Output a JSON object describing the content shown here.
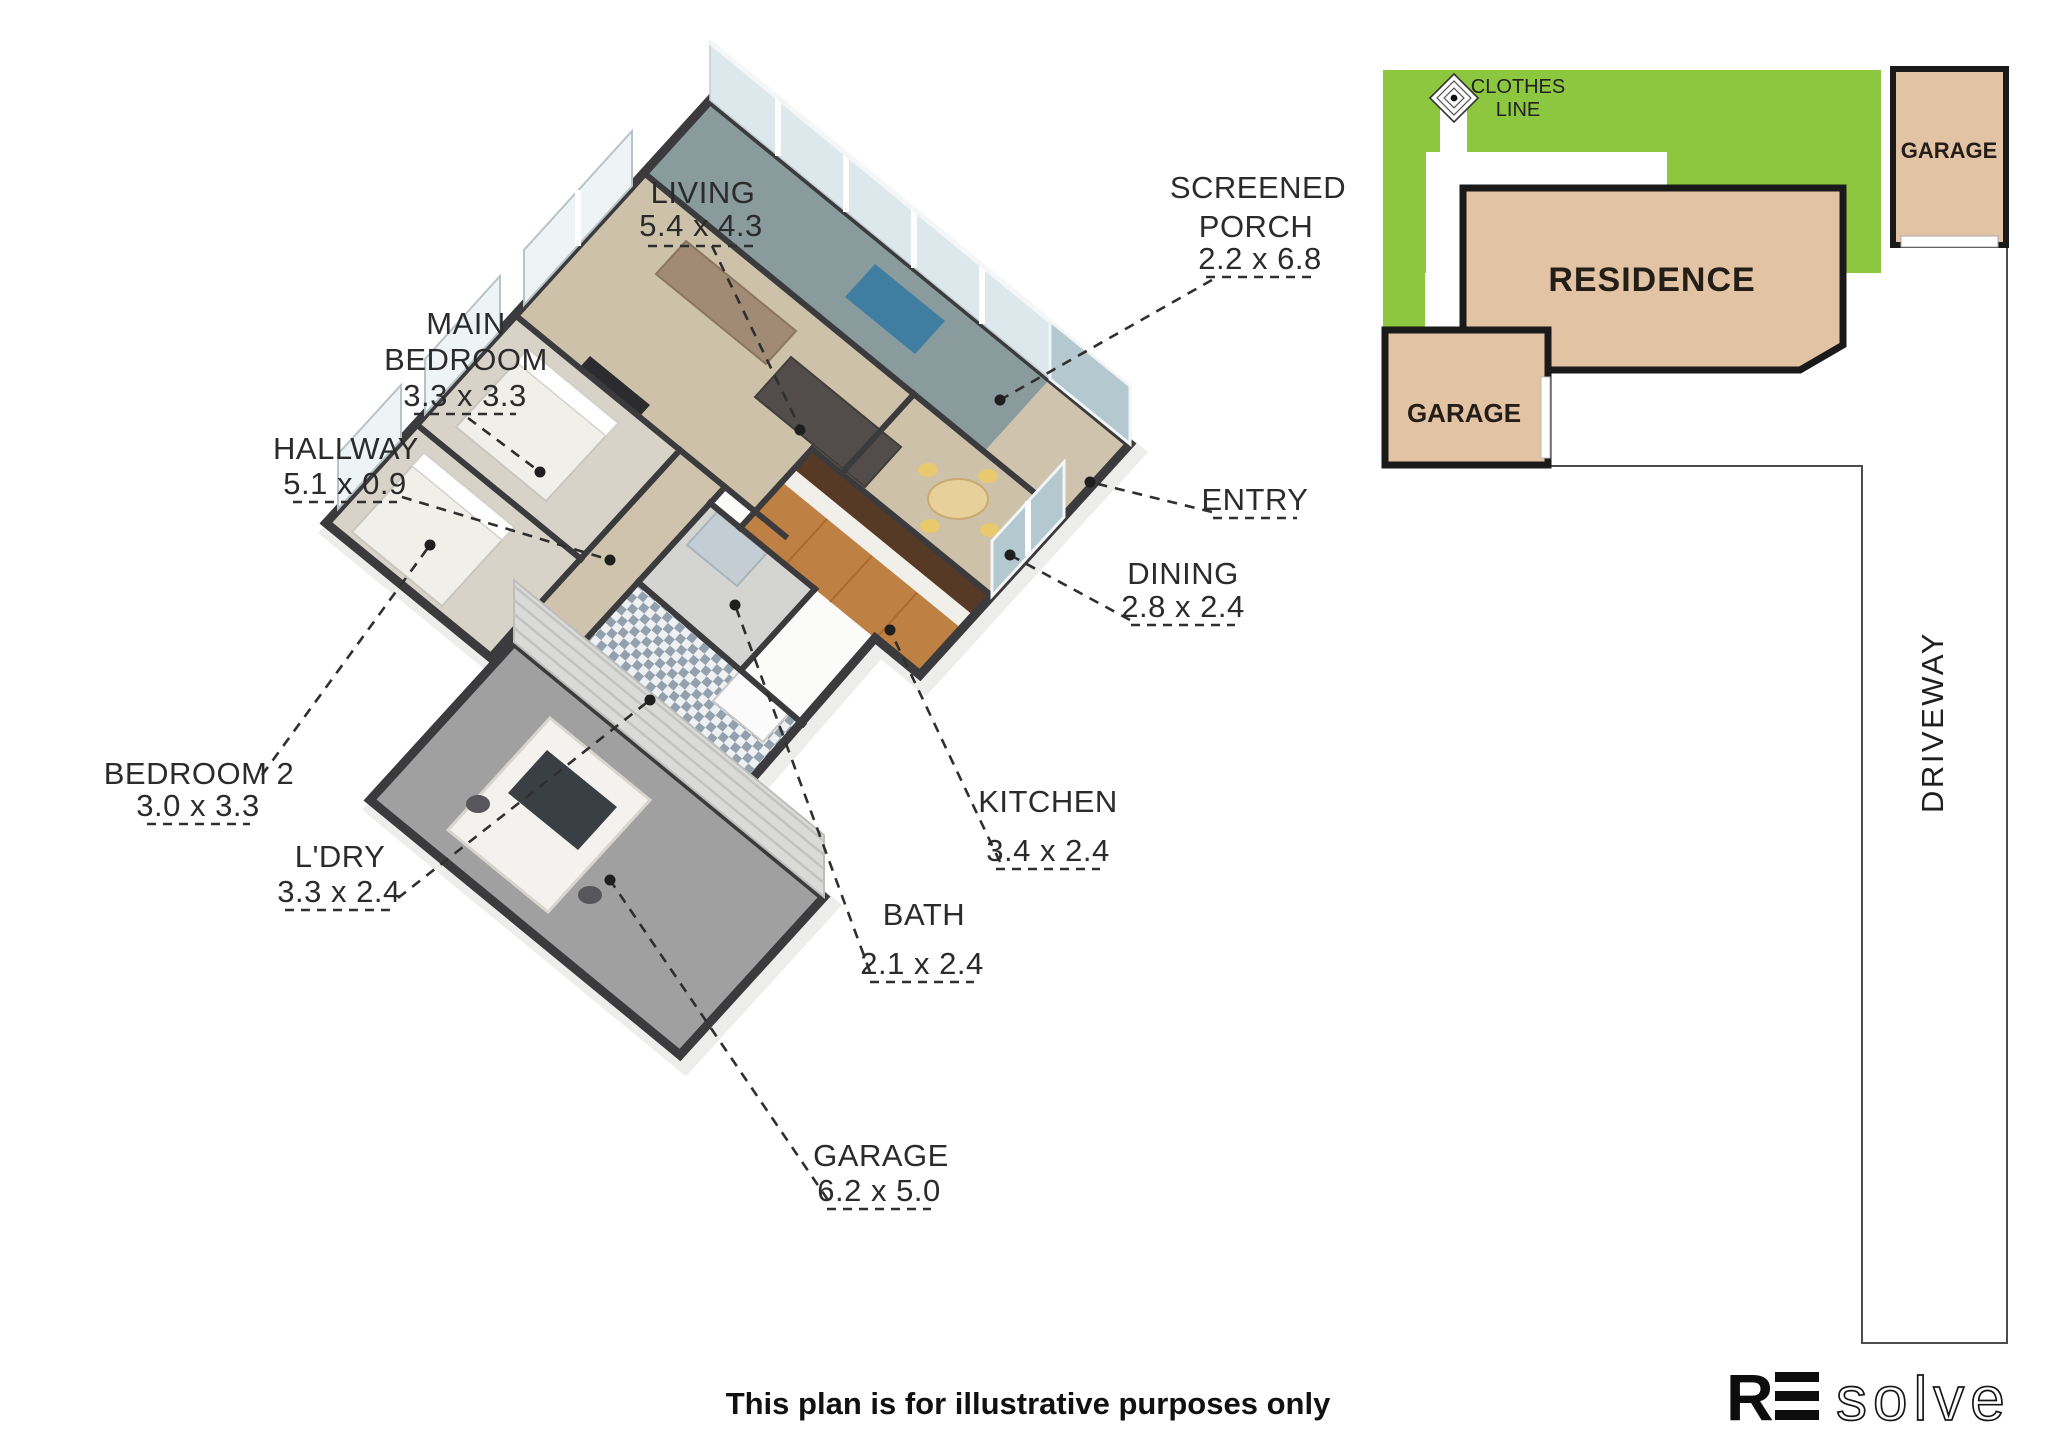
{
  "floor_plan": {
    "labels": {
      "living": {
        "name": "LIVING",
        "dims": "5.4 x 4.3"
      },
      "screened_porch": {
        "name_line1": "SCREENED",
        "name_line2": "PORCH",
        "dims": "2.2 x 6.8"
      },
      "main_bedroom": {
        "name_line1": "MAIN",
        "name_line2": "BEDROOM",
        "dims": "3.3 x 3.3"
      },
      "hallway": {
        "name": "HALLWAY",
        "dims": "5.1 x 0.9"
      },
      "entry": {
        "name": "ENTRY"
      },
      "dining": {
        "name": "DINING",
        "dims": "2.8 x 2.4"
      },
      "kitchen": {
        "name": "KITCHEN",
        "dims": "3.4 x 2.4"
      },
      "bath": {
        "name": "BATH",
        "dims": "2.1 x 2.4"
      },
      "bedroom2": {
        "name": "BEDROOM 2",
        "dims": "3.0 x 3.3"
      },
      "laundry": {
        "name": "L'DRY",
        "dims": "3.3 x 2.4"
      },
      "garage": {
        "name": "GARAGE",
        "dims": "6.2 x 5.0"
      }
    }
  },
  "site_plan": {
    "residence_label": "RESIDENCE",
    "garage_rear_label": "GARAGE",
    "garage_front_label": "GARAGE",
    "clothes_line_line1": "CLOTHES",
    "clothes_line_line2": "LINE",
    "driveway_label": "DRIVEWAY",
    "colors": {
      "lawn": "#8dc63f",
      "building": "#e2c3a3",
      "outline": "#1a1a1a"
    }
  },
  "footer": {
    "disclaimer": "This plan is for illustrative purposes only"
  },
  "logo": {
    "prefix": "R",
    "suffix": "solve"
  }
}
